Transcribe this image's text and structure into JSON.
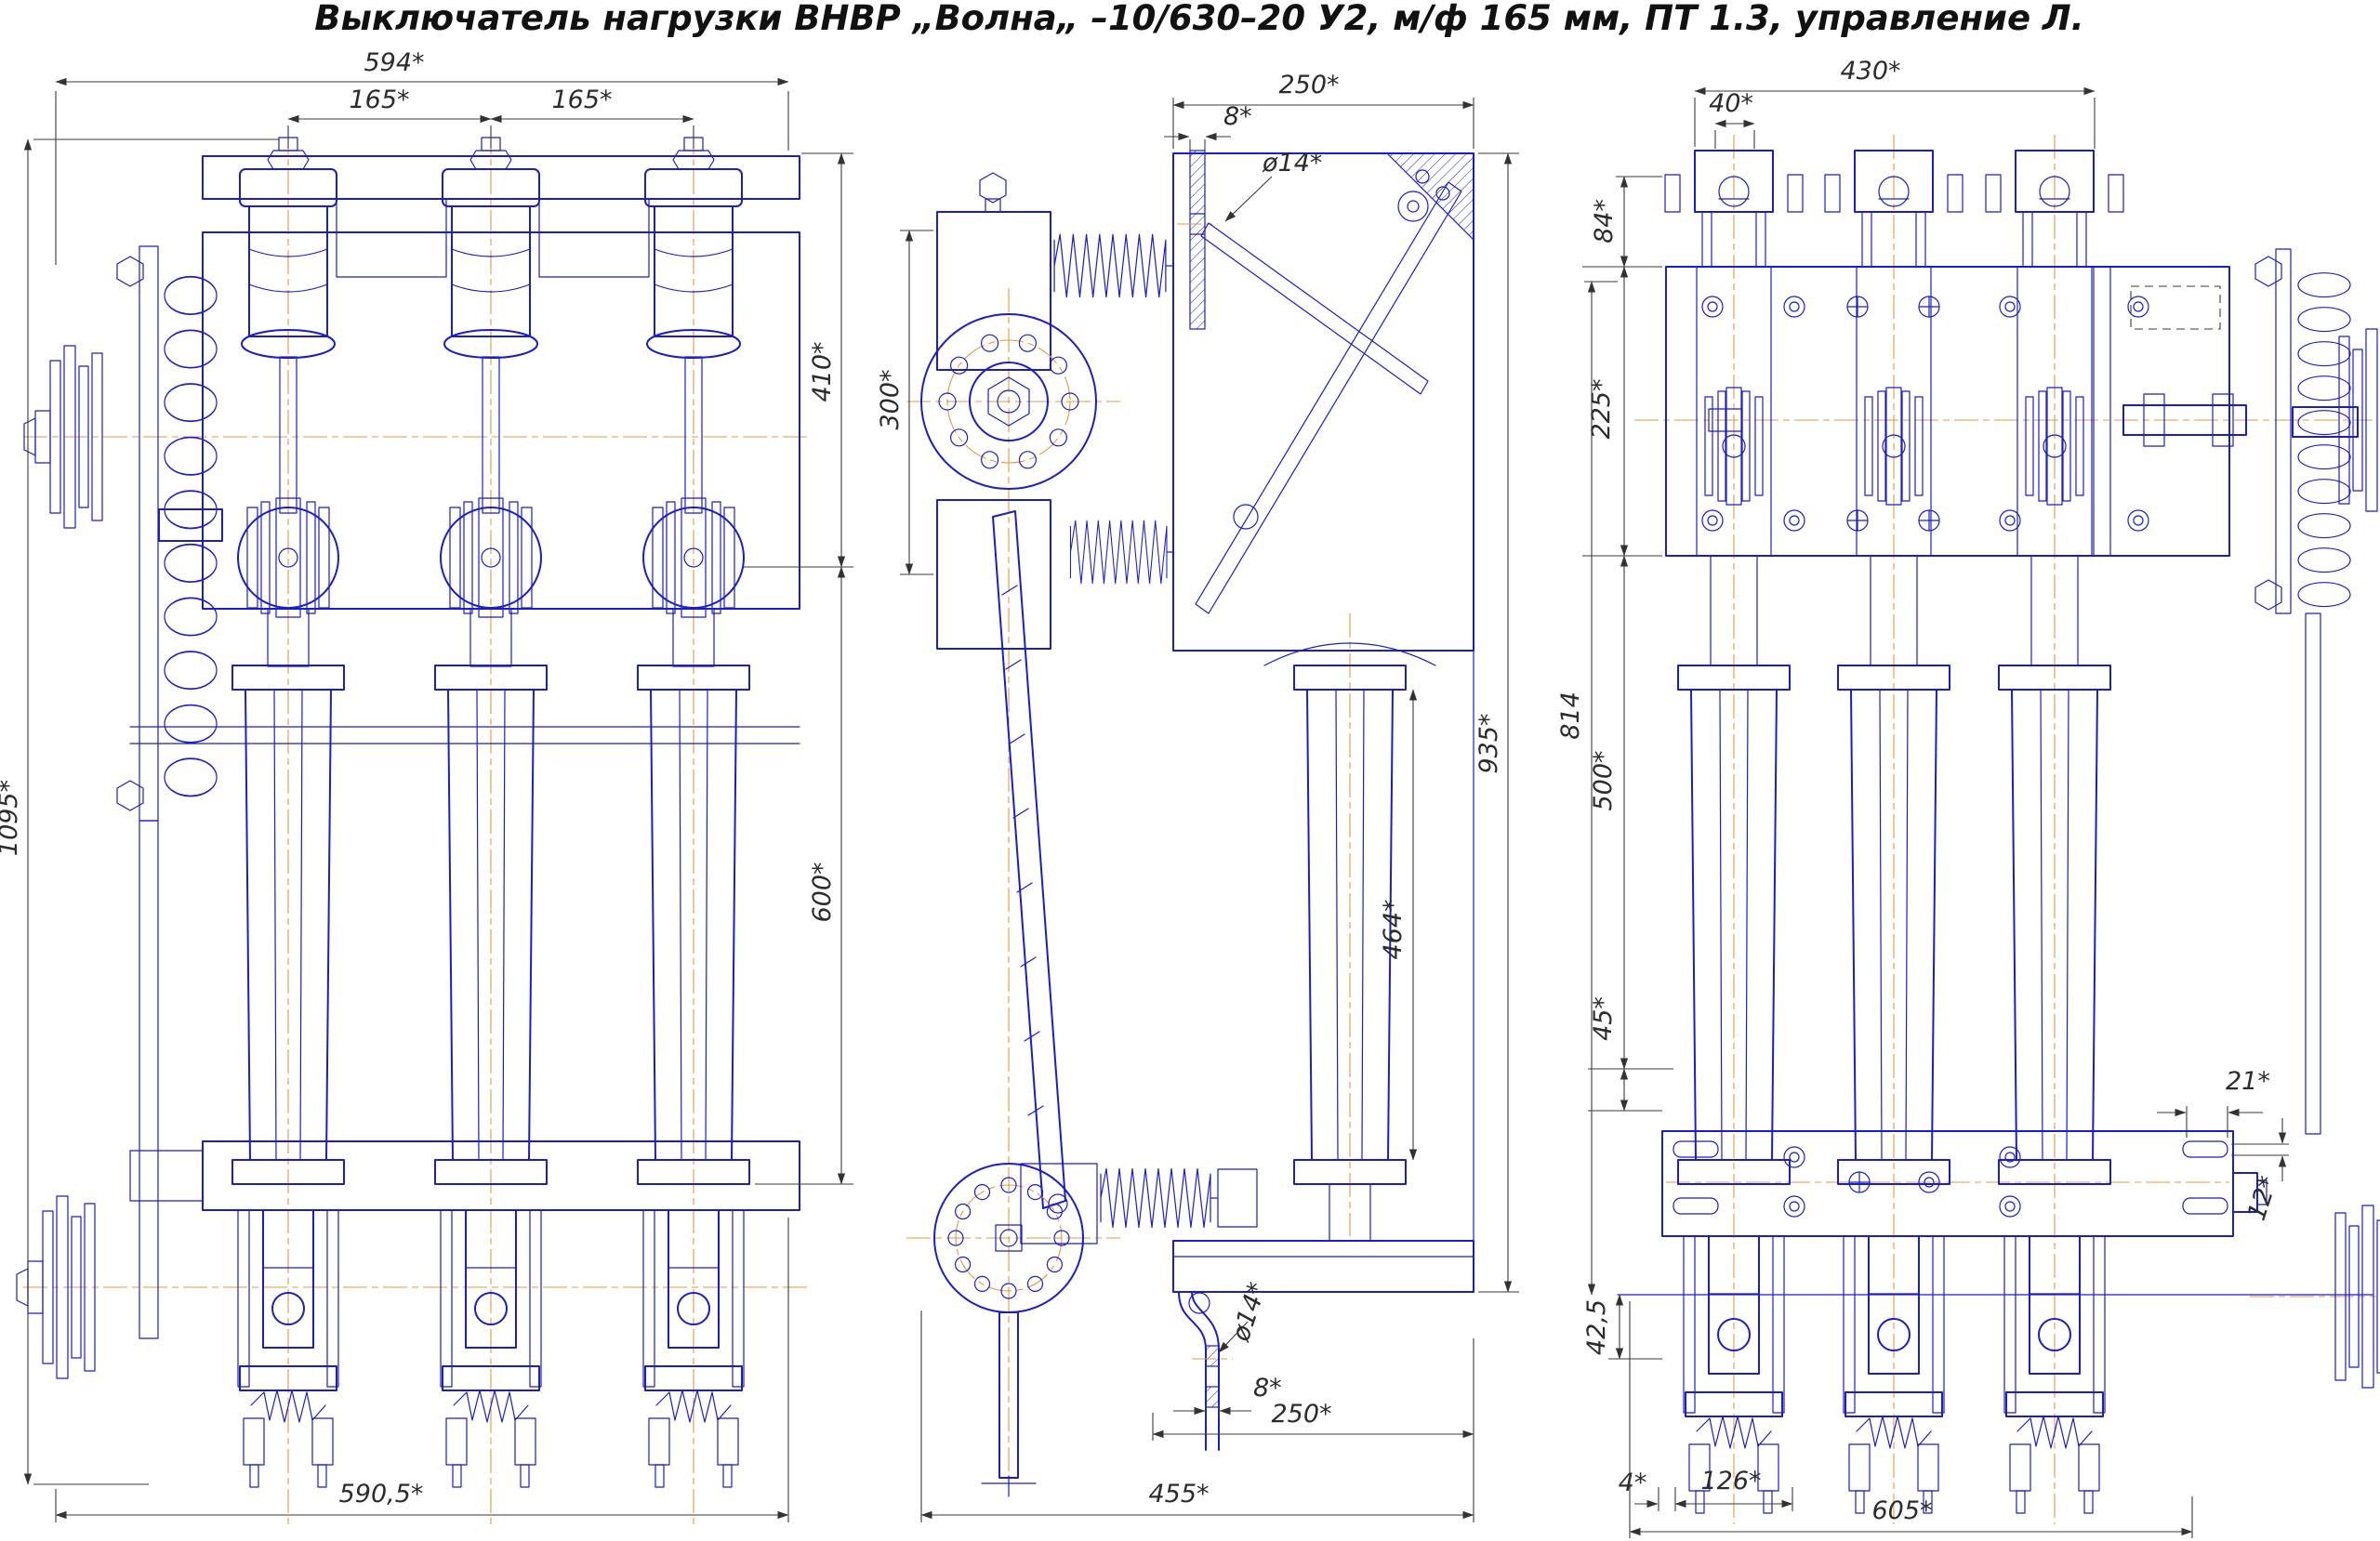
{
  "title": "Выключатель нагрузки ВНВР „Волна„ –10/630–20 У2, м/ф 165 мм, ПТ 1.3, управление Л.",
  "colors": {
    "line": "#1b1bd0",
    "center": "#e0993f",
    "dim": "#3a3a3a",
    "bg": "#ffffff"
  },
  "dims": {
    "front": {
      "overall_width": "594*",
      "pitch_left": "165*",
      "pitch_right": "165*",
      "overall_height": "1095*",
      "upper_height": "410*",
      "insulator_height": "600*",
      "base_width": "590,5*"
    },
    "side": {
      "top_depth": "250*",
      "plate_top": "8*",
      "hole_top": "ø14*",
      "drive_height": "300*",
      "frame_height": "935*",
      "insulator_height": "464*",
      "hole_bottom": "ø14*",
      "plate_bottom": "8*",
      "inner_depth": "250*",
      "base_depth": "455*"
    },
    "rear": {
      "overall_width": "430*",
      "lug_width": "40*",
      "top_offset": "84*",
      "frame_height": "225*",
      "shaft_height": "814",
      "mid_height": "500*",
      "bracket_offset": "45*",
      "base_drop": "42,5",
      "slot_offset": "21*",
      "slot_height": "12*",
      "gap": "4*",
      "pole_width": "126*",
      "base_width": "605*"
    }
  }
}
